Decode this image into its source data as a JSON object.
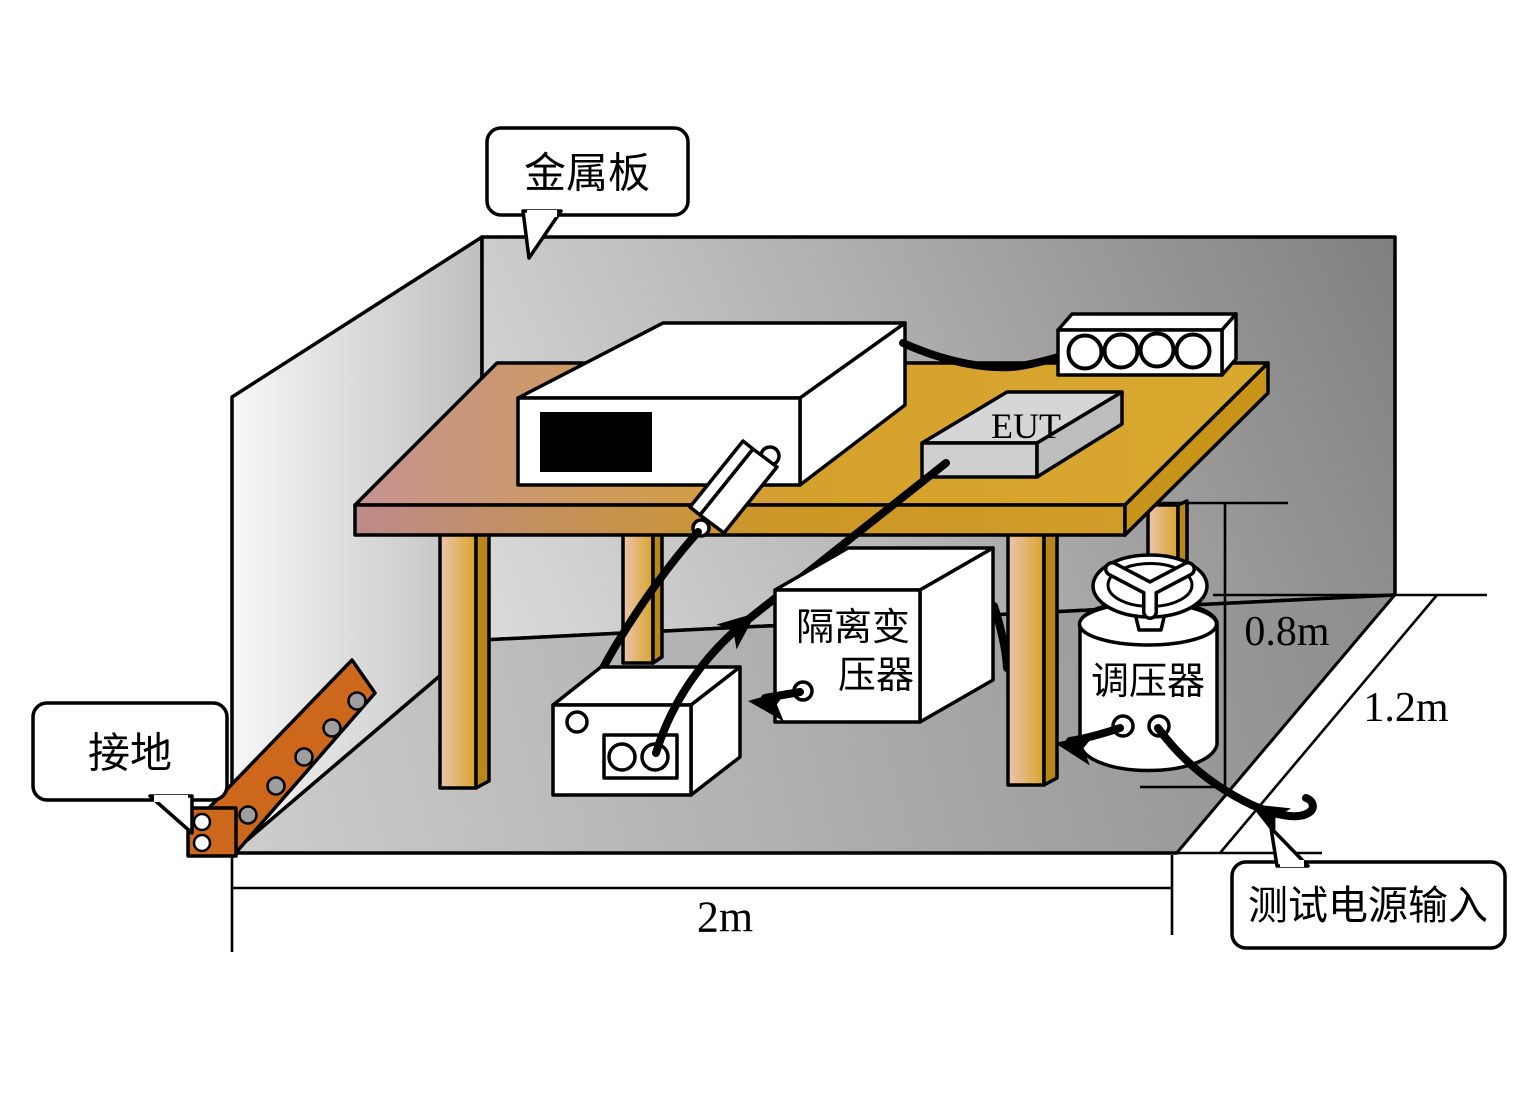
{
  "callouts": {
    "metal_plate": {
      "label": "金属板"
    },
    "grounding": {
      "label": "接地"
    },
    "test_power_input": {
      "label": "测试电源输入"
    }
  },
  "equipment": {
    "eut": {
      "label": "EUT"
    },
    "isolation_transformer": {
      "label": "隔离变压器",
      "label_line1": "隔离变",
      "label_line2": "压器"
    },
    "voltage_regulator": {
      "label": "调压器"
    }
  },
  "dimensions": {
    "table_width": "2m",
    "table_height": "0.8m",
    "table_depth": "1.2m"
  },
  "colors": {
    "ground_strap": "#cd671b",
    "table_gold": "#d8a62c",
    "table_pink": "#c59292",
    "leg_side": "#b8861b",
    "table_side": "#c79318",
    "wall_gray_dark": "#7f7f7f",
    "wall_gray_light": "#dcdcdc",
    "floor_gray": "#b5b5b5",
    "eut_gray": "#d6d6d6",
    "rivet_gray": "#9e9e9e",
    "equipment_white": "#ffffff",
    "outline": "#000000"
  }
}
